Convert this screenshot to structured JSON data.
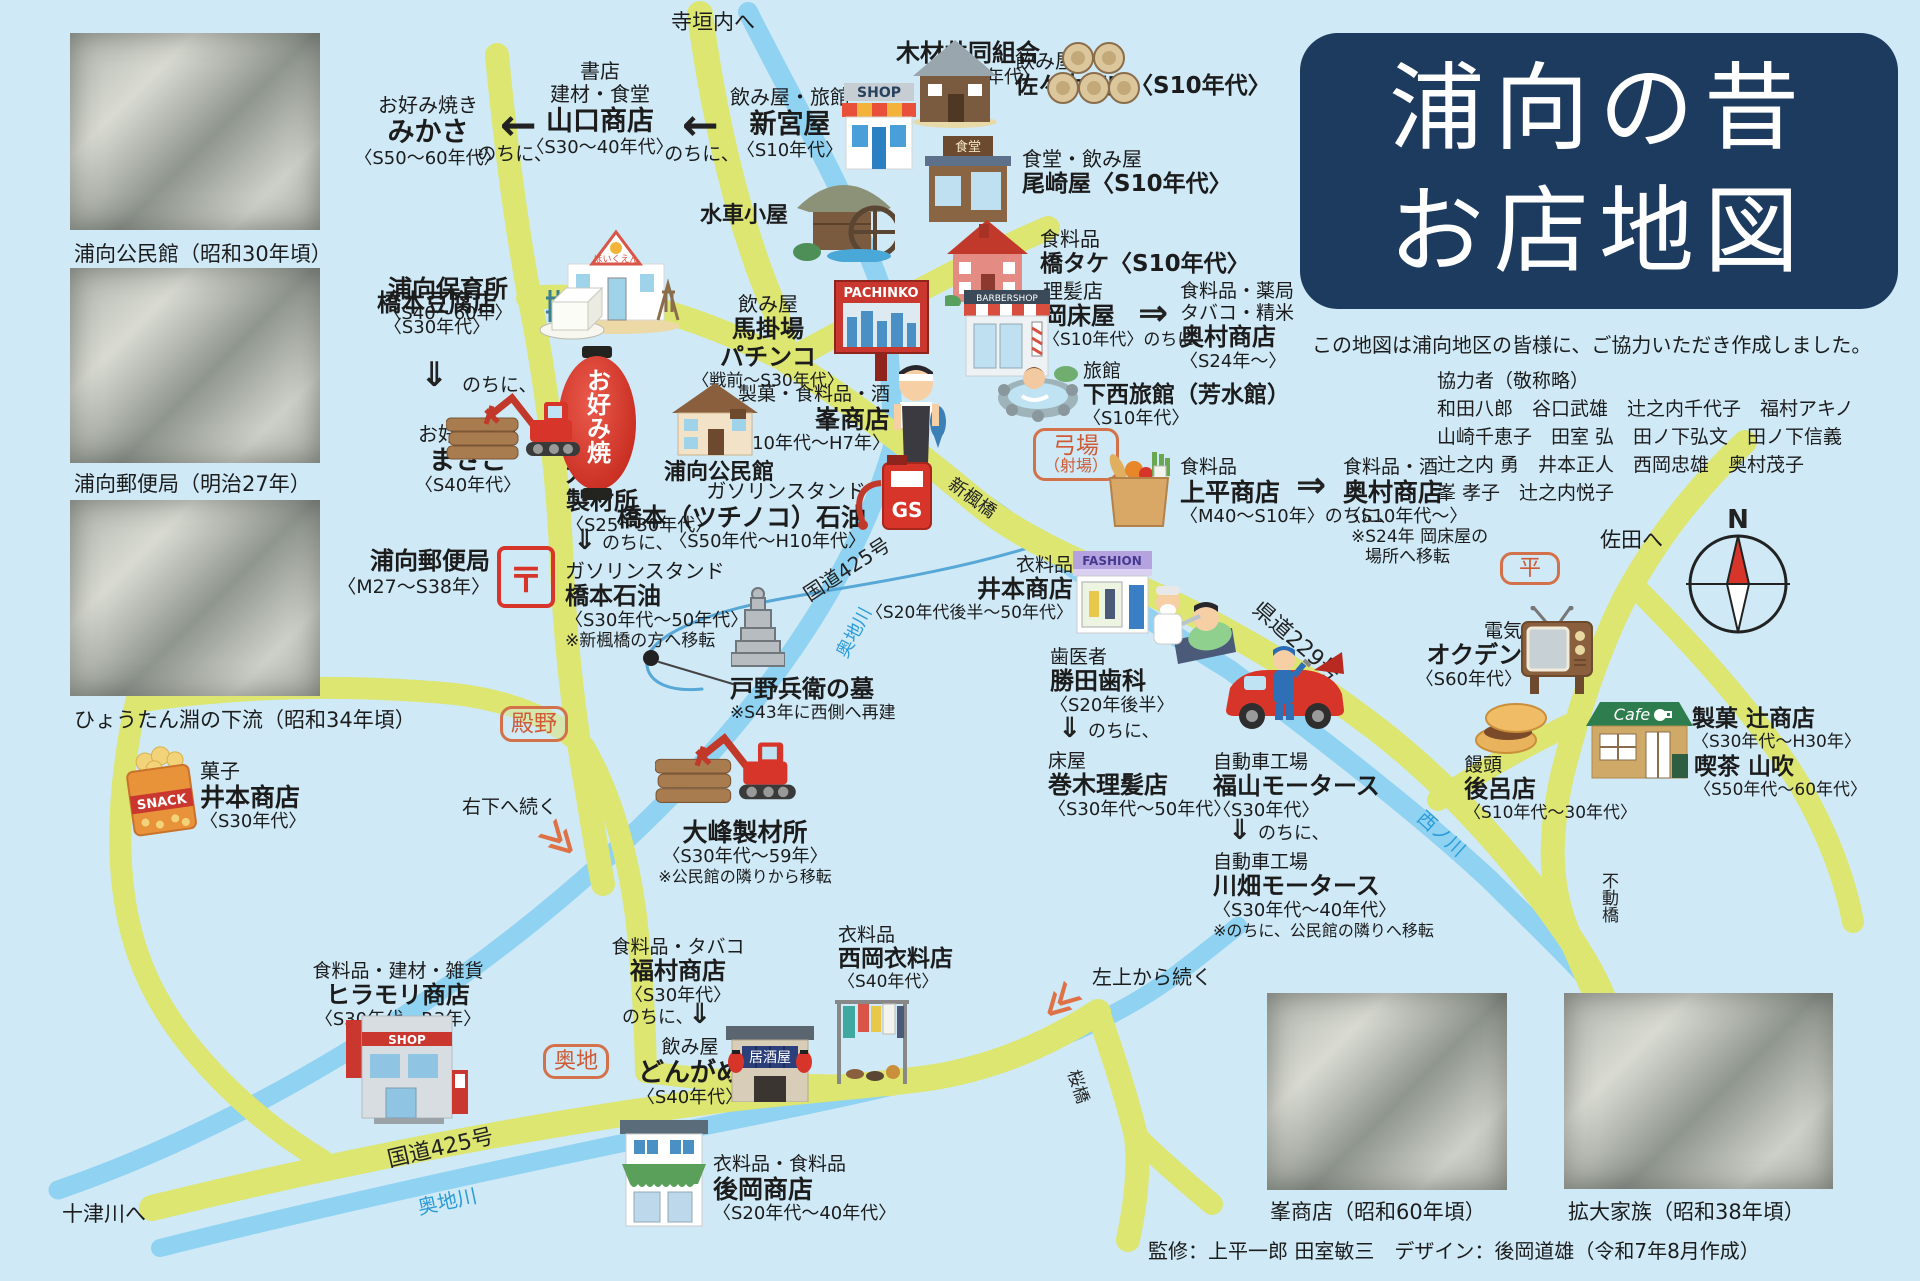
{
  "title": {
    "line1": "浦向の昔",
    "line2": "お店地図"
  },
  "intro": "この地図は浦向地区の皆様に、ご協力いただき作成しました。",
  "contributors": {
    "heading": "協力者（敬称略）",
    "line1": "和田八郎　谷口武雄　辻之内千代子　福村アキノ",
    "line2": "山崎千恵子　田室 弘　田ノ下弘文　田ノ下信義",
    "line3": "辻之内 勇　井本正人　西岡忠雄　奥村茂子",
    "line4": "峯 孝子　辻之内悦子"
  },
  "credit": "監修：上平一郎 田室敏三　デザイン：後岡道雄（令和7年8月作成）",
  "photos": {
    "p1": "浦向公民館（昭和30年頃）",
    "p2": "浦向郵便局（明治27年）",
    "p3": "ひょうたん淵の下流（昭和34年頃）",
    "p4": "峯商店（昭和60年頃）",
    "p5": "拡大家族（昭和38年頃）"
  },
  "glyphs": {
    "arrow_left": "←",
    "arrow_right": "⇒",
    "arrow_down": "⇓",
    "chevrons": "≫",
    "compass_n": "N"
  },
  "icon_texts": {
    "shop": "SHOP",
    "pachinko": "PACHINKO",
    "barber": "BARBERSHOP",
    "gs": "GS",
    "fashion": "FASHION",
    "cafe": "Cafe",
    "snack": "SNACK",
    "izakaya": "居酒屋",
    "lantern": "お好み焼",
    "shokudo": "食堂",
    "hoikuen": "ほいくえん",
    "post": "〒"
  },
  "roads": {
    "kokudo425_upper": "国道425号",
    "kokudo425_lower": "国道425号",
    "kendo229": "県道229号"
  },
  "rivers": {
    "okuchigawa_upper": "奥地川",
    "okuchigawa_lower": "奥地川",
    "nishinokawa": "西ノ川"
  },
  "bridges": {
    "kaede": "楓橋",
    "shinkaede": "新楓橋",
    "sakura": "桜橋",
    "fudou": "不動橋"
  },
  "places": {
    "nochini": "のちに、",
    "teragaito": {
      "l1": "寺垣内へ"
    },
    "mokuzai": {
      "l1": "木材共同組合",
      "l2": "〈S30年代〉"
    },
    "mikasa": {
      "l1": "お好み焼き",
      "l2": "みかさ",
      "l3": "〈S50〜60年代〉"
    },
    "yamaguchi": {
      "l1": "書店",
      "l2": "建材・食堂",
      "l3": "山口商店",
      "l4": "〈S30〜40年代〉"
    },
    "shinguya": {
      "l1": "飲み屋・旅館",
      "l2": "新宮屋",
      "l3": "〈S10年代〉"
    },
    "sasaki": {
      "l1": "飲み屋",
      "l2": "佐々木商店〈S10年代〉"
    },
    "ozakiya": {
      "l1": "食堂・飲み屋",
      "l2": "尾崎屋〈S10年代〉"
    },
    "suisha": {
      "l1": "水車小屋"
    },
    "hashitake": {
      "l1": "食料品",
      "l2": "橋タケ〈S10年代〉"
    },
    "hoikusho": {
      "l1": "浦向保育所",
      "l2": "〈S40〜60年〉"
    },
    "pachinko": {
      "l1": "飲み屋",
      "l2": "馬掛場",
      "l3": "パチンコ",
      "l4": "〈戦前〜S30年代〉"
    },
    "okatokoya": {
      "l1": "理髪店",
      "l2": "岡床屋",
      "l3": "〈S10年代〉のちに、"
    },
    "okumura1": {
      "l1": "食料品・薬局",
      "l2": "タバコ・精米",
      "l3": "奥村商店",
      "l4": "〈S24年〜〉"
    },
    "shimonishi": {
      "l1": "旅館",
      "l2": "下西旅館（芳水館）",
      "l3": "〈S10年代〉"
    },
    "tofu": {
      "l1": "橋本豆腐店",
      "l2": "〈S30年代〉"
    },
    "masago": {
      "l1": "お好み焼き",
      "l2": "まさご",
      "l3": "〈S40年代〉"
    },
    "oomine1": {
      "l1": "大峰",
      "l2": "製材所",
      "l3": "〈S25〜30年代〉"
    },
    "hashimoto_sekiyu": {
      "l1": "ガソリンスタンド",
      "l2": "橋本石油",
      "l3": "〈S30年代〜50年代〉",
      "l4": "※新楓橋の方へ移転"
    },
    "kouminkan": {
      "l1": "浦向公民館"
    },
    "mine": {
      "l1": "製菓・食料品・酒",
      "l2": "峯商店",
      "l3": "〈S10年代〜H7年〉"
    },
    "tsuchinoko": {
      "l1": "ガソリンスタンド",
      "l2": "橋本（ツチノコ）石油",
      "l3": "〈S50年代〜H10年代〉"
    },
    "yuubinkyoku": {
      "l1": "浦向郵便局",
      "l2": "〈M27〜S38年〉"
    },
    "yumiba": {
      "l1": "弓場",
      "l2": "（射場）"
    },
    "kamidaira": {
      "l1": "食料品",
      "l2": "上平商店",
      "l3": "〈M40〜S10年〉のちに、"
    },
    "okumura2": {
      "l1": "食料品・酒",
      "l2": "奥村商店",
      "l3": "〈S10年代〜〉",
      "l4": "※S24年 岡床屋の",
      "l5": "場所へ移転"
    },
    "imoto_fashion": {
      "l1": "衣料品",
      "l2": "井本商店",
      "l3": "〈S20年代後半〜50年代〉"
    },
    "haka": {
      "l1": "戸野兵衛の墓",
      "l2": "※S43年に西側へ再建"
    },
    "tonono": {
      "l1": "殿野"
    },
    "migishita": {
      "l1": "右下へ続く"
    },
    "oomine2": {
      "l1": "大峰製材所",
      "l2": "〈S30年代〜59年〉",
      "l3": "※公民館の隣りから移転"
    },
    "katsuta": {
      "l1": "歯医者",
      "l2": "勝田歯科",
      "l3": "〈S20年後半〉"
    },
    "makigi": {
      "l1": "床屋",
      "l2": "巻木理髪店",
      "l3": "〈S30年代〜50年代〉"
    },
    "fukuyama": {
      "l1": "自動車工場",
      "l2": "福山モータース",
      "l3": "〈S30年代〉"
    },
    "kawabata": {
      "l1": "自動車工場",
      "l2": "川畑モータース",
      "l3": "〈S30年代〜40年代〉",
      "l4": "※のちに、公民館の隣りへ移転"
    },
    "hira": {
      "l1": "平"
    },
    "sada": {
      "l1": "佐田へ"
    },
    "okuden": {
      "l1": "電気",
      "l2": "オクデン",
      "l3": "〈S60年代〉"
    },
    "goro": {
      "l1": "饅頭",
      "l2": "後呂店",
      "l3": "〈S10年代〜30年代〉"
    },
    "tsuji": {
      "l1": "製菓 辻商店",
      "l2": "〈S30年代〜H30年〉"
    },
    "yamabuki": {
      "l1": "喫茶 山吹",
      "l2": "〈S50年代〜60年代〉"
    },
    "imoto_kashi": {
      "l1": "菓子",
      "l2": "井本商店",
      "l3": "〈S30年代〉"
    },
    "hiramori": {
      "l1": "食料品・建材・雑貨",
      "l2": "ヒラモリ商店",
      "l3": "〈S30年代〜R3年〉"
    },
    "okuchi": {
      "l1": "奥地"
    },
    "fukumura": {
      "l1": "食料品・タバコ",
      "l2": "福村商店",
      "l3": "〈S30年代〉"
    },
    "dongame": {
      "l1": "飲み屋",
      "l2": "どんがめ",
      "l3": "〈S40年代〉"
    },
    "nishioka": {
      "l1": "衣料品",
      "l2": "西岡衣料店",
      "l3": "〈S40年代〉"
    },
    "atooka": {
      "l1": "衣料品・食料品",
      "l2": "後岡商店",
      "l3": "〈S20年代〜40年代〉"
    },
    "hidariue": {
      "l1": "左上から続く"
    },
    "totsukawa": {
      "l1": "十津川へ"
    }
  }
}
